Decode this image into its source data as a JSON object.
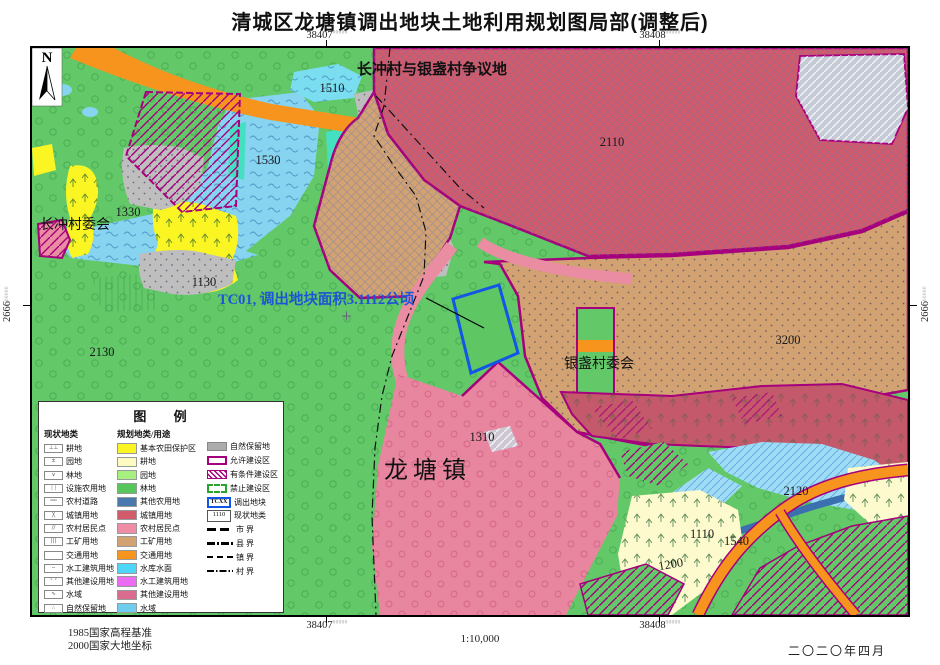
{
  "title": "清城区龙塘镇调出地块土地利用规划图局部(调整后)",
  "frame": {
    "grid_x_left": {
      "main": "38407",
      "sup": "00000"
    },
    "grid_x_right": {
      "main": "38408",
      "sup": "00000"
    },
    "grid_y_left": {
      "main": "2666",
      "sup": "00000"
    },
    "grid_y_right": {
      "main": "2666",
      "sup": "00000"
    }
  },
  "map": {
    "north": "N",
    "labels": {
      "dispute_area": "长冲村与银盏村争议地",
      "changchong_committee": "长冲村委会",
      "yinzhan_committee": "银盏村委会",
      "longtang_town": "龙塘镇",
      "tc01_note": "TC01, 调出地块面积3.1112公顷",
      "code_1510": "1510",
      "code_1530": "1530",
      "code_1330": "1330",
      "code_1130": "1130",
      "code_2130": "2130",
      "code_2110": "2110",
      "code_3200": "3200",
      "code_1310": "1310",
      "code_2120": "2120",
      "code_1110": "1110",
      "code_1540": "1540",
      "code_1200": "1200"
    }
  },
  "legend": {
    "title": "图  例",
    "col_current": {
      "header": "现状地类",
      "items": [
        {
          "label": "耕地",
          "glyph": "⊥⊥"
        },
        {
          "label": "园地",
          "glyph": "±"
        },
        {
          "label": "林地",
          "glyph": "∨"
        },
        {
          "label": "设施农用地",
          "glyph": "┆┆"
        },
        {
          "label": "农村道路",
          "glyph": "╍╍"
        },
        {
          "label": "城镇用地",
          "glyph": "╳"
        },
        {
          "label": "农村居民点",
          "glyph": "∕∕"
        },
        {
          "label": "工矿用地",
          "glyph": "|||"
        },
        {
          "label": "交通用地",
          "glyph": ""
        },
        {
          "label": "水工建筑用地",
          "glyph": "╌"
        },
        {
          "label": "其他建设用地",
          "glyph": "ˣ ˣ"
        },
        {
          "label": "水域",
          "glyph": "∿"
        },
        {
          "label": "自然保留地",
          "glyph": "∴"
        }
      ]
    },
    "col_planned": {
      "header": "规划地类/用途",
      "items": [
        {
          "label": "基本农田保护区",
          "color": "#FBF623"
        },
        {
          "label": "耕地",
          "color": "#FDFBC0"
        },
        {
          "label": "园地",
          "color": "#A7EF7E"
        },
        {
          "label": "林地",
          "color": "#57C75B"
        },
        {
          "label": "其他农用地",
          "color": "#4A79AE"
        },
        {
          "label": "城镇用地",
          "color": "#D15A6B"
        },
        {
          "label": "农村居民点",
          "color": "#EF8CA6"
        },
        {
          "label": "工矿用地",
          "color": "#D2A273"
        },
        {
          "label": "交通用地",
          "color": "#F7941E"
        },
        {
          "label": "水库水面",
          "color": "#4FD5F7"
        },
        {
          "label": "水工建筑用地",
          "color": "#EC6BF3"
        },
        {
          "label": "其他建设用地",
          "color": "#D96C8E"
        },
        {
          "label": "水域",
          "color": "#6FCDEF"
        }
      ]
    },
    "col_zoning": {
      "items": [
        {
          "label": "自然保留地"
        },
        {
          "label": "允许建设区"
        },
        {
          "label": "有条件建设区"
        },
        {
          "label": "禁止建设区"
        },
        {
          "label": "调出地块",
          "box_text": "TCXX"
        },
        {
          "label": "现状地类",
          "box_text": "1110"
        },
        {
          "label": "市  界"
        },
        {
          "label": "县  界"
        },
        {
          "label": "镇  界"
        },
        {
          "label": "村  界"
        }
      ]
    }
  },
  "footer": {
    "datum_line1": "1985国家高程基准",
    "datum_line2": "2000国家大地坐标",
    "scale": "1:10,000",
    "date": "二〇二〇年四月"
  },
  "colors": {
    "allowed_zone_border": "#A6007C",
    "forbidden_zone_border": "#2AA52A",
    "parcel_outline": "#1256E8",
    "annotation_text": "#1D55D5",
    "forest_green": "#62C868",
    "urban_red": "#D15A6B",
    "mining_tan": "#D2A273",
    "road_orange": "#F7941E",
    "water_blue": "#86D4F0"
  }
}
